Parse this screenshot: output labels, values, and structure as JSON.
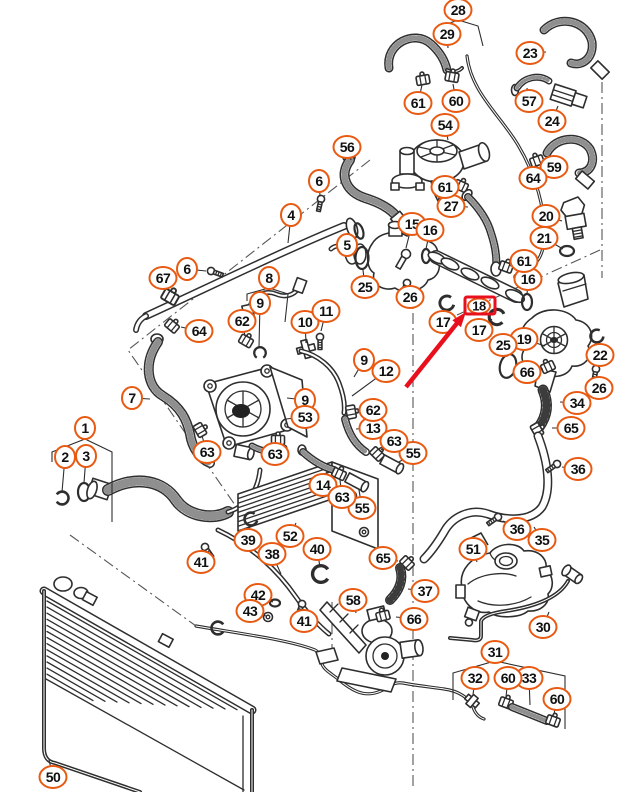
{
  "colors": {
    "callout_stroke": "#e85a12",
    "line": "#2e2e2e",
    "highlight": "#e8101c",
    "background": "#ffffff"
  },
  "callouts": [
    {
      "n": "1",
      "x": 85,
      "y": 428
    },
    {
      "n": "2",
      "x": 65,
      "y": 457,
      "lx": 62,
      "ly": 492
    },
    {
      "n": "3",
      "x": 86,
      "y": 456,
      "lx": 84,
      "ly": 483
    },
    {
      "n": "4",
      "x": 291,
      "y": 215,
      "lx": 288,
      "ly": 243
    },
    {
      "n": "5",
      "x": 347,
      "y": 245,
      "lx": 358,
      "ly": 236
    },
    {
      "n": "6",
      "x": 187,
      "y": 269,
      "lx": 206,
      "ly": 271
    },
    {
      "n": "6",
      "x": 319,
      "y": 181,
      "lx": 320,
      "ly": 196
    },
    {
      "n": "7",
      "x": 132,
      "y": 398,
      "lx": 150,
      "ly": 399
    },
    {
      "n": "8",
      "x": 269,
      "y": 278
    },
    {
      "n": "9",
      "x": 260,
      "y": 303,
      "lx": 259,
      "ly": 347
    },
    {
      "n": "9",
      "x": 305,
      "y": 400,
      "lx": 287,
      "ly": 398
    },
    {
      "n": "9",
      "x": 364,
      "y": 360,
      "lx": 354,
      "ly": 377
    },
    {
      "n": "10",
      "x": 305,
      "y": 322,
      "lx": 306,
      "ly": 343
    },
    {
      "n": "11",
      "x": 326,
      "y": 311,
      "lx": 321,
      "ly": 331
    },
    {
      "n": "12",
      "x": 386,
      "y": 371,
      "lx": 352,
      "ly": 396
    },
    {
      "n": "13",
      "x": 373,
      "y": 428,
      "lx": 356,
      "ly": 429
    },
    {
      "n": "14",
      "x": 323,
      "y": 485,
      "lx": 327,
      "ly": 471
    },
    {
      "n": "15",
      "x": 412,
      "y": 224,
      "lx": 406,
      "ly": 248
    },
    {
      "n": "16",
      "x": 430,
      "y": 230,
      "lx": 426,
      "ly": 249
    },
    {
      "n": "16",
      "x": 528,
      "y": 279,
      "lx": 527,
      "ly": 295
    },
    {
      "n": "17",
      "x": 443,
      "y": 322,
      "lx": 446,
      "ly": 309
    },
    {
      "n": "17",
      "x": 479,
      "y": 330,
      "lx": 492,
      "ly": 319
    },
    {
      "n": "18",
      "x": 479,
      "y": 306,
      "highlight": true
    },
    {
      "n": "19",
      "x": 524,
      "y": 339,
      "lx": 545,
      "ly": 346
    },
    {
      "n": "20",
      "x": 546,
      "y": 216,
      "lx": 562,
      "ly": 221
    },
    {
      "n": "21",
      "x": 544,
      "y": 238,
      "lx": 563,
      "ly": 249
    },
    {
      "n": "22",
      "x": 600,
      "y": 355,
      "lx": 598,
      "ly": 342
    },
    {
      "n": "23",
      "x": 530,
      "y": 53,
      "lx": 546,
      "ly": 52
    },
    {
      "n": "24",
      "x": 552,
      "y": 121,
      "lx": 558,
      "ly": 106
    },
    {
      "n": "25",
      "x": 365,
      "y": 287,
      "lx": 363,
      "ly": 270
    },
    {
      "n": "25",
      "x": 503,
      "y": 345,
      "lx": 507,
      "ly": 357
    },
    {
      "n": "26",
      "x": 410,
      "y": 297,
      "lx": 408,
      "ly": 286
    },
    {
      "n": "26",
      "x": 599,
      "y": 388,
      "lx": 597,
      "ly": 378
    },
    {
      "n": "27",
      "x": 451,
      "y": 206,
      "lx": 468,
      "ly": 207
    },
    {
      "n": "28",
      "x": 458,
      "y": 10
    },
    {
      "n": "29",
      "x": 447,
      "y": 34,
      "lx": 448,
      "ly": 48
    },
    {
      "n": "30",
      "x": 543,
      "y": 627,
      "lx": 549,
      "ly": 612
    },
    {
      "n": "31",
      "x": 495,
      "y": 652
    },
    {
      "n": "32",
      "x": 475,
      "y": 678,
      "lx": 473,
      "ly": 695
    },
    {
      "n": "33",
      "x": 529,
      "y": 678,
      "lx": 530,
      "ly": 705
    },
    {
      "n": "34",
      "x": 577,
      "y": 403,
      "lx": 560,
      "ly": 402
    },
    {
      "n": "35",
      "x": 542,
      "y": 540,
      "lx": 534,
      "ly": 527
    },
    {
      "n": "36",
      "x": 578,
      "y": 469,
      "lx": 562,
      "ly": 467
    },
    {
      "n": "36",
      "x": 517,
      "y": 529,
      "lx": 503,
      "ly": 521
    },
    {
      "n": "37",
      "x": 425,
      "y": 591,
      "lx": 408,
      "ly": 589
    },
    {
      "n": "38",
      "x": 272,
      "y": 554,
      "lx": 281,
      "ly": 574
    },
    {
      "n": "39",
      "x": 248,
      "y": 540,
      "lx": 250,
      "ly": 524
    },
    {
      "n": "40",
      "x": 317,
      "y": 549,
      "lx": 320,
      "ly": 567
    },
    {
      "n": "41",
      "x": 201,
      "y": 562,
      "lx": 203,
      "ly": 552
    },
    {
      "n": "41",
      "x": 304,
      "y": 621,
      "lx": 303,
      "ly": 609
    },
    {
      "n": "42",
      "x": 258,
      "y": 595,
      "lx": 273,
      "ly": 602
    },
    {
      "n": "43",
      "x": 250,
      "y": 611,
      "lx": 266,
      "ly": 616
    },
    {
      "n": "50",
      "x": 53,
      "y": 777,
      "lx": 49,
      "ly": 760
    },
    {
      "n": "51",
      "x": 473,
      "y": 549,
      "lx": 477,
      "ly": 562
    },
    {
      "n": "52",
      "x": 290,
      "y": 536,
      "lx": 296,
      "ly": 523
    },
    {
      "n": "53",
      "x": 305,
      "y": 417,
      "lx": 286,
      "ly": 419
    },
    {
      "n": "54",
      "x": 445,
      "y": 125,
      "lx": 448,
      "ly": 140
    },
    {
      "n": "55",
      "x": 413,
      "y": 453,
      "lx": 399,
      "ly": 462
    },
    {
      "n": "55",
      "x": 362,
      "y": 508,
      "lx": 359,
      "ly": 490
    },
    {
      "n": "56",
      "x": 347,
      "y": 147,
      "lx": 351,
      "ly": 160
    },
    {
      "n": "57",
      "x": 529,
      "y": 101,
      "lx": 527,
      "ly": 88
    },
    {
      "n": "58",
      "x": 353,
      "y": 600,
      "lx": 356,
      "ly": 613
    },
    {
      "n": "59",
      "x": 554,
      "y": 167,
      "lx": 546,
      "ly": 159
    },
    {
      "n": "60",
      "x": 456,
      "y": 101,
      "lx": 453,
      "ly": 84
    },
    {
      "n": "60",
      "x": 508,
      "y": 678,
      "lx": 506,
      "ly": 697
    },
    {
      "n": "60",
      "x": 557,
      "y": 699,
      "lx": 554,
      "ly": 714
    },
    {
      "n": "61",
      "x": 418,
      "y": 103,
      "lx": 422,
      "ly": 85
    },
    {
      "n": "61",
      "x": 445,
      "y": 187,
      "lx": 456,
      "ly": 186
    },
    {
      "n": "61",
      "x": 524,
      "y": 261,
      "lx": 510,
      "ly": 266
    },
    {
      "n": "62",
      "x": 242,
      "y": 321,
      "lx": 245,
      "ly": 336
    },
    {
      "n": "62",
      "x": 373,
      "y": 410,
      "lx": 357,
      "ly": 411
    },
    {
      "n": "63",
      "x": 207,
      "y": 452,
      "lx": 202,
      "ly": 436
    },
    {
      "n": "63",
      "x": 275,
      "y": 454,
      "lx": 277,
      "ly": 446
    },
    {
      "n": "63",
      "x": 394,
      "y": 441,
      "lx": 381,
      "ly": 450
    },
    {
      "n": "63",
      "x": 342,
      "y": 497,
      "lx": 340,
      "ly": 480
    },
    {
      "n": "64",
      "x": 199,
      "y": 331,
      "lx": 181,
      "ly": 327
    },
    {
      "n": "64",
      "x": 533,
      "y": 178,
      "lx": 536,
      "ly": 165
    },
    {
      "n": "65",
      "x": 571,
      "y": 428,
      "lx": 552,
      "ly": 428
    },
    {
      "n": "65",
      "x": 383,
      "y": 558,
      "lx": 398,
      "ly": 561
    },
    {
      "n": "66",
      "x": 527,
      "y": 372,
      "lx": 543,
      "ly": 369
    },
    {
      "n": "66",
      "x": 414,
      "y": 619,
      "lx": 396,
      "ly": 617
    },
    {
      "n": "67",
      "x": 163,
      "y": 278,
      "lx": 170,
      "ly": 292
    }
  ],
  "bracket_lines": [
    [
      [
        52,
        462
      ],
      [
        52,
        452
      ],
      [
        85,
        439
      ],
      [
        112,
        452
      ],
      [
        112,
        522
      ]
    ],
    [
      [
        247,
        301
      ],
      [
        247,
        294
      ],
      [
        269,
        288
      ],
      [
        288,
        294
      ],
      [
        285,
        322
      ]
    ],
    [
      [
        442,
        34
      ],
      [
        442,
        26
      ],
      [
        458,
        20
      ],
      [
        478,
        26
      ],
      [
        483,
        46
      ]
    ],
    [
      [
        453,
        700
      ],
      [
        453,
        673
      ],
      [
        495,
        661
      ],
      [
        565,
        676
      ],
      [
        565,
        729
      ]
    ]
  ],
  "annotation": {
    "type": "highlight-arrow",
    "target_item": "18",
    "box": {
      "x": 465,
      "y": 297,
      "w": 30,
      "h": 17
    },
    "arrow": {
      "x1": 406,
      "y1": 387,
      "x2": 466,
      "y2": 312
    },
    "color": "#e8101c"
  }
}
